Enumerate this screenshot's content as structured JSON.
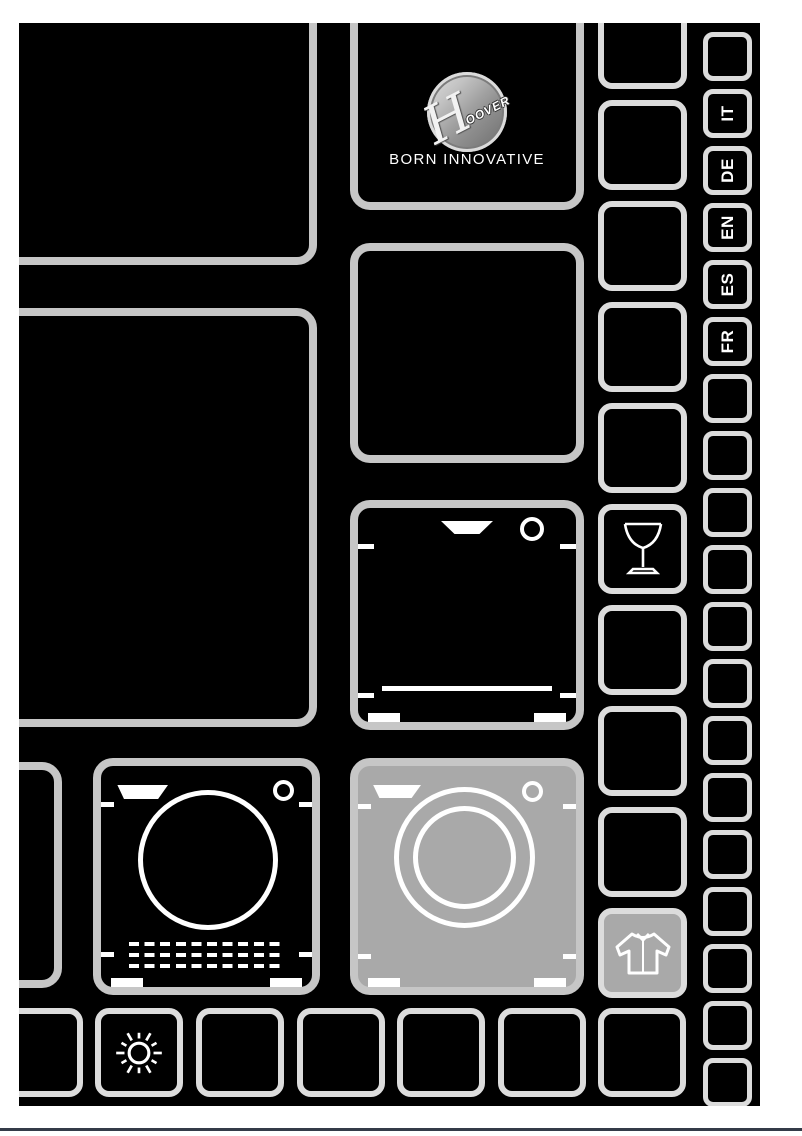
{
  "brand": {
    "name": "HOOVER",
    "wordmark_h": "H",
    "wordmark_rest": "OOVER",
    "tagline": "BORN INNOVATIVE"
  },
  "languages": [
    {
      "code": "IT"
    },
    {
      "code": "DE"
    },
    {
      "code": "EN"
    },
    {
      "code": "ES"
    },
    {
      "code": "FR"
    }
  ],
  "icons": {
    "logo": "hoover-logo",
    "glass": "wine-glass-icon",
    "dishwasher": "dishwasher-icon",
    "dryer": "tumble-dryer-icon",
    "washer": "washing-machine-icon",
    "shirt": "shirt-icon",
    "sun": "sun-icon"
  },
  "colors": {
    "page_bg": "#ffffff",
    "canvas_bg": "#000000",
    "tile_border": "#c6c6c6",
    "tile_border_light": "#dcdcdc",
    "tile_fill_gray": "#a9a9a9",
    "icon_stroke": "#ffffff",
    "footer_rule": "#343b48"
  }
}
